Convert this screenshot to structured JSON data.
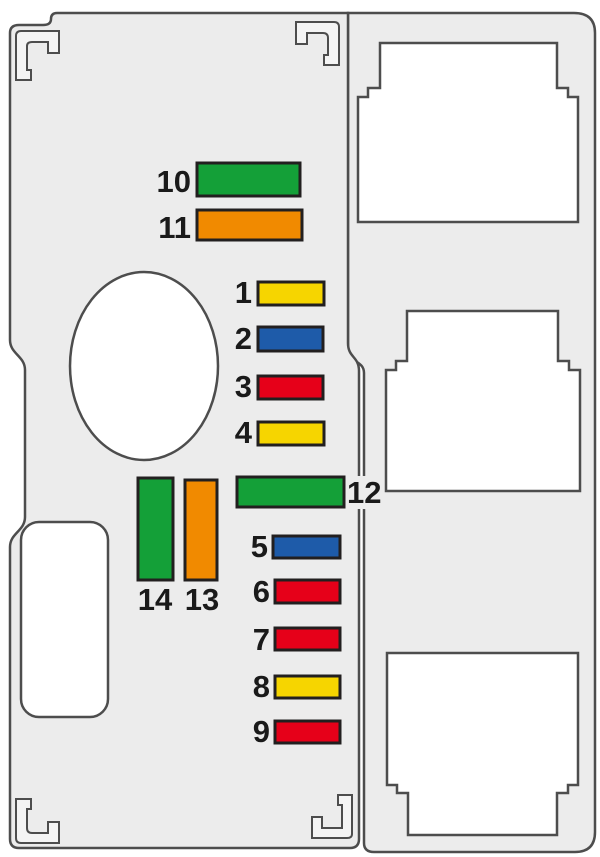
{
  "diagram": {
    "kind": "fuse-box-diagram",
    "colors": {
      "background": "#FFFFFF",
      "panel": "#ECECEC",
      "outline": "#4D4D4D",
      "cutout_fill": "#FFFFFF",
      "fuse_border": "#221F1F",
      "label": "#1A1A1A",
      "mark_fill": "#F4F4F4"
    },
    "fuse_colors": {
      "yellow": "#F6D500",
      "blue": "#1E5BA9",
      "red": "#E60019",
      "green": "#14A038",
      "orange": "#F18A00"
    },
    "fuses": [
      {
        "id": "1",
        "label": "1",
        "color_name": "yellow",
        "color": "#F6D500",
        "orientation": "horizontal"
      },
      {
        "id": "2",
        "label": "2",
        "color_name": "blue",
        "color": "#1E5BA9",
        "orientation": "horizontal"
      },
      {
        "id": "3",
        "label": "3",
        "color_name": "red",
        "color": "#E60019",
        "orientation": "horizontal"
      },
      {
        "id": "4",
        "label": "4",
        "color_name": "yellow",
        "color": "#F6D500",
        "orientation": "horizontal"
      },
      {
        "id": "5",
        "label": "5",
        "color_name": "blue",
        "color": "#1E5BA9",
        "orientation": "horizontal"
      },
      {
        "id": "6",
        "label": "6",
        "color_name": "red",
        "color": "#E60019",
        "orientation": "horizontal"
      },
      {
        "id": "7",
        "label": "7",
        "color_name": "red",
        "color": "#E60019",
        "orientation": "horizontal"
      },
      {
        "id": "8",
        "label": "8",
        "color_name": "yellow",
        "color": "#F6D500",
        "orientation": "horizontal"
      },
      {
        "id": "9",
        "label": "9",
        "color_name": "red",
        "color": "#E60019",
        "orientation": "horizontal"
      },
      {
        "id": "10",
        "label": "10",
        "color_name": "green",
        "color": "#14A038",
        "orientation": "horizontal"
      },
      {
        "id": "11",
        "label": "11",
        "color_name": "orange",
        "color": "#F18A00",
        "orientation": "horizontal"
      },
      {
        "id": "12",
        "label": "12",
        "color_name": "green",
        "color": "#14A038",
        "orientation": "horizontal"
      },
      {
        "id": "13",
        "label": "13",
        "color_name": "orange",
        "color": "#F18A00",
        "orientation": "vertical"
      },
      {
        "id": "14",
        "label": "14",
        "color_name": "green",
        "color": "#14A038",
        "orientation": "vertical"
      }
    ],
    "relay_slots": 3,
    "cutouts": [
      "round-hole",
      "oblong-hole"
    ],
    "corner_marks": 4
  }
}
